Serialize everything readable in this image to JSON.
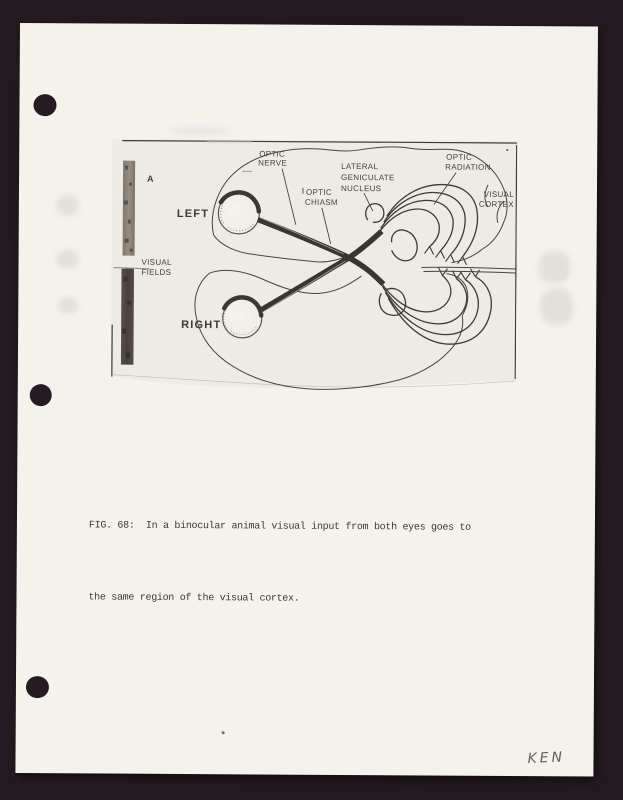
{
  "page": {
    "type": "scanned-document-page",
    "background_color": "#231b20",
    "paper_color": "#f4f2ed",
    "ink_color": "#3e3933",
    "punch_hole_count": 3
  },
  "figure": {
    "panel_label": "A",
    "sidebar_label": {
      "line1": "VISUAL",
      "line2": "FIELDS"
    },
    "eye_labels": {
      "left": "LEFT",
      "right": "RIGHT"
    },
    "labels": {
      "optic_nerve": {
        "line1": "OPTIC",
        "line2": "NERVE"
      },
      "optic_chiasm": {
        "line1": "OPTIC",
        "line2": "CHIASM"
      },
      "lateral_geniculate_nucleus": {
        "line1": "LATERAL",
        "line2": "GENICULATE",
        "line3": "NUCLEUS"
      },
      "optic_radiation": {
        "line1": "OPTIC",
        "line2": "RADIATION"
      },
      "visual_cortex": {
        "line1": "VISUAL",
        "line2": "CORTEX"
      }
    },
    "bar_colors": {
      "upper": "#8b857b",
      "lower": "#4f4841"
    }
  },
  "caption": {
    "line1": "FIG. 68:  In a binocular animal visual input from both eyes goes to",
    "line2": "the same region of the visual cortex."
  },
  "handwriting": {
    "text": "KEN"
  }
}
